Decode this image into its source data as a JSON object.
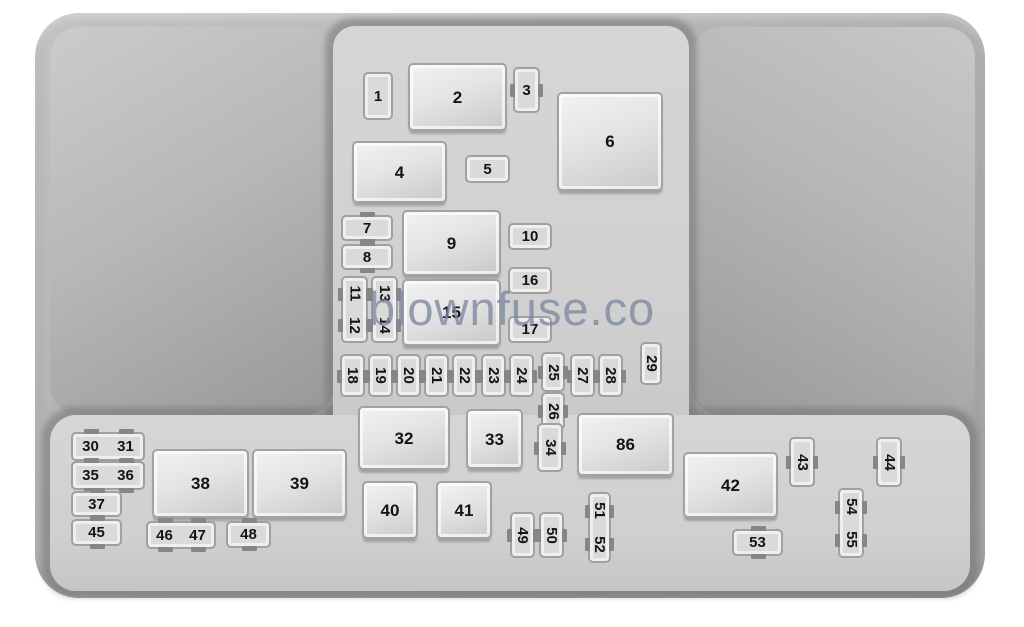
{
  "watermark": "blownfuse.co",
  "diagram_title": "Engine compartment fuse box layout",
  "colors": {
    "page_bg": "#ffffff",
    "shell_gray": "#adadad",
    "wing_gray_light": "#c9c9c9",
    "wing_gray_dark": "#989898",
    "platform_gray": "#d2d2d2",
    "component_face": "#e8e8e8",
    "component_border": "#a0a0a0",
    "label_color": "#141414",
    "watermark_color": "#7c86a0"
  },
  "components": [
    {
      "id": "1",
      "type": "fuse",
      "labels": [
        "1"
      ],
      "x": 363,
      "y": 72,
      "w": 30,
      "h": 48,
      "rot": false,
      "ticks": "none"
    },
    {
      "id": "2",
      "type": "relay",
      "labels": [
        "2"
      ],
      "x": 408,
      "y": 63,
      "w": 99,
      "h": 68,
      "rot": false,
      "ticks": "none"
    },
    {
      "id": "3",
      "type": "fuse",
      "labels": [
        "3"
      ],
      "x": 513,
      "y": 67,
      "w": 27,
      "h": 46,
      "rot": false,
      "ticks": "v"
    },
    {
      "id": "4",
      "type": "relay",
      "labels": [
        "4"
      ],
      "x": 352,
      "y": 141,
      "w": 95,
      "h": 62,
      "rot": false,
      "ticks": "none"
    },
    {
      "id": "5",
      "type": "fuse",
      "labels": [
        "5"
      ],
      "x": 465,
      "y": 155,
      "w": 45,
      "h": 28,
      "rot": false,
      "ticks": "none"
    },
    {
      "id": "6",
      "type": "relay",
      "labels": [
        "6"
      ],
      "x": 557,
      "y": 92,
      "w": 106,
      "h": 99,
      "rot": false,
      "ticks": "none"
    },
    {
      "id": "7",
      "type": "fuse",
      "labels": [
        "7"
      ],
      "x": 341,
      "y": 215,
      "w": 52,
      "h": 26,
      "rot": false,
      "ticks": "h"
    },
    {
      "id": "8",
      "type": "fuse",
      "labels": [
        "8"
      ],
      "x": 341,
      "y": 244,
      "w": 52,
      "h": 26,
      "rot": false,
      "ticks": "h"
    },
    {
      "id": "9",
      "type": "relay",
      "labels": [
        "9"
      ],
      "x": 402,
      "y": 210,
      "w": 99,
      "h": 66,
      "rot": false,
      "ticks": "none"
    },
    {
      "id": "10",
      "type": "fuse",
      "labels": [
        "10"
      ],
      "x": 508,
      "y": 223,
      "w": 44,
      "h": 27,
      "rot": false,
      "ticks": "none"
    },
    {
      "id": "11-12",
      "type": "fuse",
      "labels": [
        "11",
        "12"
      ],
      "x": 341,
      "y": 276,
      "w": 27,
      "h": 67,
      "rot": true,
      "ticks": "v"
    },
    {
      "id": "13-14",
      "type": "fuse",
      "labels": [
        "13",
        "14"
      ],
      "x": 371,
      "y": 276,
      "w": 27,
      "h": 67,
      "rot": true,
      "ticks": "v"
    },
    {
      "id": "15",
      "type": "relay",
      "labels": [
        "15"
      ],
      "x": 402,
      "y": 279,
      "w": 99,
      "h": 67,
      "rot": false,
      "ticks": "none"
    },
    {
      "id": "16",
      "type": "fuse",
      "labels": [
        "16"
      ],
      "x": 508,
      "y": 267,
      "w": 44,
      "h": 27,
      "rot": false,
      "ticks": "none"
    },
    {
      "id": "17",
      "type": "fuse",
      "labels": [
        "17"
      ],
      "x": 508,
      "y": 316,
      "w": 44,
      "h": 27,
      "rot": false,
      "ticks": "none"
    },
    {
      "id": "18",
      "type": "fuse",
      "labels": [
        "18"
      ],
      "x": 340,
      "y": 354,
      "w": 25,
      "h": 43,
      "rot": true,
      "ticks": "v"
    },
    {
      "id": "19",
      "type": "fuse",
      "labels": [
        "19"
      ],
      "x": 368,
      "y": 354,
      "w": 25,
      "h": 43,
      "rot": true,
      "ticks": "v"
    },
    {
      "id": "20",
      "type": "fuse",
      "labels": [
        "20"
      ],
      "x": 396,
      "y": 354,
      "w": 25,
      "h": 43,
      "rot": true,
      "ticks": "v"
    },
    {
      "id": "21",
      "type": "fuse",
      "labels": [
        "21"
      ],
      "x": 424,
      "y": 354,
      "w": 25,
      "h": 43,
      "rot": true,
      "ticks": "v"
    },
    {
      "id": "22",
      "type": "fuse",
      "labels": [
        "22"
      ],
      "x": 452,
      "y": 354,
      "w": 25,
      "h": 43,
      "rot": true,
      "ticks": "v"
    },
    {
      "id": "23",
      "type": "fuse",
      "labels": [
        "23"
      ],
      "x": 481,
      "y": 354,
      "w": 25,
      "h": 43,
      "rot": true,
      "ticks": "v"
    },
    {
      "id": "24",
      "type": "fuse",
      "labels": [
        "24"
      ],
      "x": 509,
      "y": 354,
      "w": 25,
      "h": 43,
      "rot": true,
      "ticks": "v"
    },
    {
      "id": "25",
      "type": "fuse",
      "labels": [
        "25"
      ],
      "x": 541,
      "y": 352,
      "w": 24,
      "h": 40,
      "rot": true,
      "ticks": "v"
    },
    {
      "id": "26",
      "type": "fuse",
      "labels": [
        "26"
      ],
      "x": 541,
      "y": 392,
      "w": 24,
      "h": 38,
      "rot": true,
      "ticks": "v"
    },
    {
      "id": "27",
      "type": "fuse",
      "labels": [
        "27"
      ],
      "x": 570,
      "y": 354,
      "w": 25,
      "h": 43,
      "rot": true,
      "ticks": "v"
    },
    {
      "id": "28",
      "type": "fuse",
      "labels": [
        "28"
      ],
      "x": 598,
      "y": 354,
      "w": 25,
      "h": 43,
      "rot": true,
      "ticks": "v"
    },
    {
      "id": "29",
      "type": "fuse",
      "labels": [
        "29"
      ],
      "x": 640,
      "y": 342,
      "w": 22,
      "h": 43,
      "rot": true,
      "ticks": "none"
    },
    {
      "id": "30-31",
      "type": "fuse",
      "labels": [
        "30",
        "31"
      ],
      "x": 71,
      "y": 432,
      "w": 74,
      "h": 29,
      "rot": false,
      "ticks": "h"
    },
    {
      "id": "35-36",
      "type": "fuse",
      "labels": [
        "35",
        "36"
      ],
      "x": 71,
      "y": 461,
      "w": 74,
      "h": 29,
      "rot": false,
      "ticks": "h"
    },
    {
      "id": "37",
      "type": "fuse",
      "labels": [
        "37"
      ],
      "x": 71,
      "y": 491,
      "w": 51,
      "h": 26,
      "rot": false,
      "ticks": "h"
    },
    {
      "id": "45",
      "type": "fuse",
      "labels": [
        "45"
      ],
      "x": 71,
      "y": 519,
      "w": 51,
      "h": 27,
      "rot": false,
      "ticks": "h"
    },
    {
      "id": "38",
      "type": "relay",
      "labels": [
        "38"
      ],
      "x": 152,
      "y": 449,
      "w": 97,
      "h": 69,
      "rot": false,
      "ticks": "none"
    },
    {
      "id": "39",
      "type": "relay",
      "labels": [
        "39"
      ],
      "x": 252,
      "y": 449,
      "w": 95,
      "h": 69,
      "rot": false,
      "ticks": "none"
    },
    {
      "id": "46-47",
      "type": "fuse",
      "labels": [
        "46",
        "47"
      ],
      "x": 146,
      "y": 521,
      "w": 70,
      "h": 28,
      "rot": false,
      "ticks": "h"
    },
    {
      "id": "48",
      "type": "fuse",
      "labels": [
        "48"
      ],
      "x": 226,
      "y": 521,
      "w": 45,
      "h": 27,
      "rot": false,
      "ticks": "h"
    },
    {
      "id": "32",
      "type": "relay",
      "labels": [
        "32"
      ],
      "x": 358,
      "y": 406,
      "w": 92,
      "h": 64,
      "rot": false,
      "ticks": "none"
    },
    {
      "id": "33",
      "type": "relay",
      "labels": [
        "33"
      ],
      "x": 466,
      "y": 409,
      "w": 57,
      "h": 60,
      "rot": false,
      "ticks": "none"
    },
    {
      "id": "34",
      "type": "fuse",
      "labels": [
        "34"
      ],
      "x": 537,
      "y": 423,
      "w": 26,
      "h": 49,
      "rot": true,
      "ticks": "v"
    },
    {
      "id": "86",
      "type": "relay",
      "labels": [
        "86"
      ],
      "x": 577,
      "y": 413,
      "w": 97,
      "h": 63,
      "rot": false,
      "ticks": "none"
    },
    {
      "id": "40",
      "type": "relay",
      "labels": [
        "40"
      ],
      "x": 362,
      "y": 481,
      "w": 56,
      "h": 58,
      "rot": false,
      "ticks": "none"
    },
    {
      "id": "41",
      "type": "relay",
      "labels": [
        "41"
      ],
      "x": 436,
      "y": 481,
      "w": 56,
      "h": 58,
      "rot": false,
      "ticks": "none"
    },
    {
      "id": "49",
      "type": "fuse",
      "labels": [
        "49"
      ],
      "x": 510,
      "y": 512,
      "w": 25,
      "h": 46,
      "rot": true,
      "ticks": "v"
    },
    {
      "id": "50",
      "type": "fuse",
      "labels": [
        "50"
      ],
      "x": 539,
      "y": 512,
      "w": 25,
      "h": 46,
      "rot": true,
      "ticks": "v"
    },
    {
      "id": "51-52",
      "type": "fuse",
      "labels": [
        "51",
        "52"
      ],
      "x": 588,
      "y": 492,
      "w": 23,
      "h": 71,
      "rot": true,
      "ticks": "v"
    },
    {
      "id": "42",
      "type": "relay",
      "labels": [
        "42"
      ],
      "x": 683,
      "y": 452,
      "w": 95,
      "h": 66,
      "rot": false,
      "ticks": "none"
    },
    {
      "id": "43",
      "type": "fuse",
      "labels": [
        "43"
      ],
      "x": 789,
      "y": 437,
      "w": 26,
      "h": 50,
      "rot": true,
      "ticks": "v"
    },
    {
      "id": "44",
      "type": "fuse",
      "labels": [
        "44"
      ],
      "x": 876,
      "y": 437,
      "w": 26,
      "h": 50,
      "rot": true,
      "ticks": "v"
    },
    {
      "id": "54-55",
      "type": "fuse",
      "labels": [
        "54",
        "55"
      ],
      "x": 838,
      "y": 488,
      "w": 26,
      "h": 70,
      "rot": true,
      "ticks": "v"
    },
    {
      "id": "53",
      "type": "fuse",
      "labels": [
        "53"
      ],
      "x": 732,
      "y": 529,
      "w": 51,
      "h": 27,
      "rot": false,
      "ticks": "h"
    }
  ]
}
